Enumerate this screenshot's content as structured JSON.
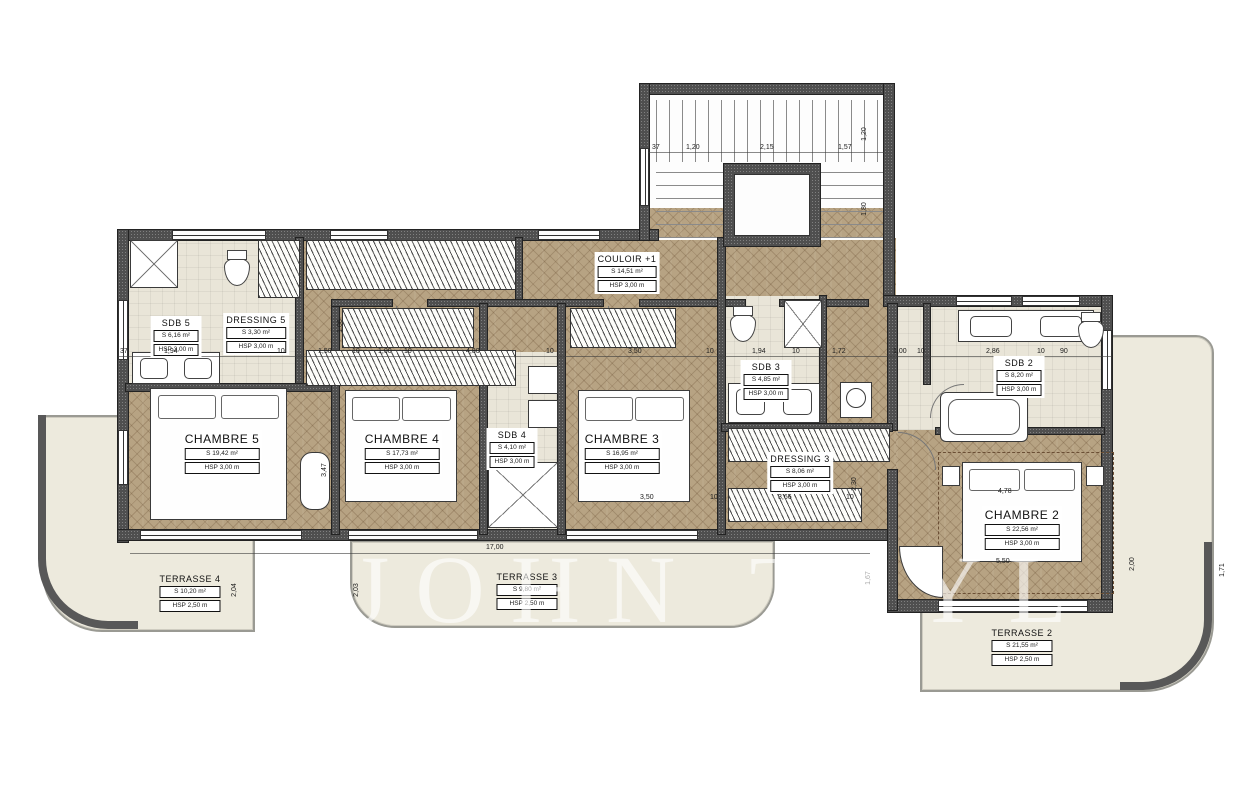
{
  "watermark": "JOHN TAYL",
  "rooms": {
    "chambre5": {
      "title": "CHAMBRE 5",
      "area": "S 19,42 m²",
      "hsp": "HSP 3,00 m"
    },
    "chambre4": {
      "title": "CHAMBRE 4",
      "area": "S 17,73 m²",
      "hsp": "HSP 3,00 m"
    },
    "chambre3": {
      "title": "CHAMBRE 3",
      "area": "S 16,95 m²",
      "hsp": "HSP 3,00 m"
    },
    "chambre2": {
      "title": "CHAMBRE 2",
      "area": "S 22,56 m²",
      "hsp": "HSP 3,00 m"
    },
    "couloir": {
      "title": "COULOIR +1",
      "area": "S 14,51 m²",
      "hsp": "HSP 3,00 m"
    },
    "sdb5": {
      "title": "SDB 5",
      "area": "S 6,16 m²",
      "hsp": "HSP 3,00 m"
    },
    "dressing5": {
      "title": "DRESSING 5",
      "area": "S 3,30 m²",
      "hsp": "HSP 3,00 m"
    },
    "sdb4": {
      "title": "SDB 4",
      "area": "S 4,10 m²",
      "hsp": "HSP 3,00 m"
    },
    "sdb3": {
      "title": "SDB 3",
      "area": "S 4,85 m²",
      "hsp": "HSP 3,00 m"
    },
    "dressing3": {
      "title": "DRESSING 3",
      "area": "S 8,06 m²",
      "hsp": "HSP 3,00 m"
    },
    "sdb2": {
      "title": "SDB 2",
      "area": "S 8,20 m²",
      "hsp": "HSP 3,00 m"
    },
    "terrasse4": {
      "title": "TERRASSE 4",
      "area": "S 10,20 m²",
      "hsp": "HSP 2,50 m"
    },
    "terrasse3": {
      "title": "TERRASSE 3",
      "area": "S 9,80 m²",
      "hsp": "HSP 2,50 m"
    },
    "terrasse2": {
      "title": "TERRASSE 2",
      "area": "S 21,55 m²",
      "hsp": "HSP 2,50 m"
    }
  },
  "dims": [
    "37",
    "1,94",
    "10",
    "1,50",
    "10",
    "1,00",
    "10",
    "4,80",
    "10",
    "3,50",
    "10",
    "1,94",
    "10",
    "1,72",
    "1,00",
    "10",
    "2,86",
    "10",
    "90",
    "17,00",
    "4,78",
    "5,50",
    "37",
    "1,20",
    "2,15",
    "1,57",
    "1,20",
    "1,80",
    "2,04",
    "3,47",
    "2,03",
    "2,30",
    "1,67",
    "2,00",
    "1,71",
    "1,06",
    "3,50",
    "10",
    "3,66",
    "10"
  ]
}
